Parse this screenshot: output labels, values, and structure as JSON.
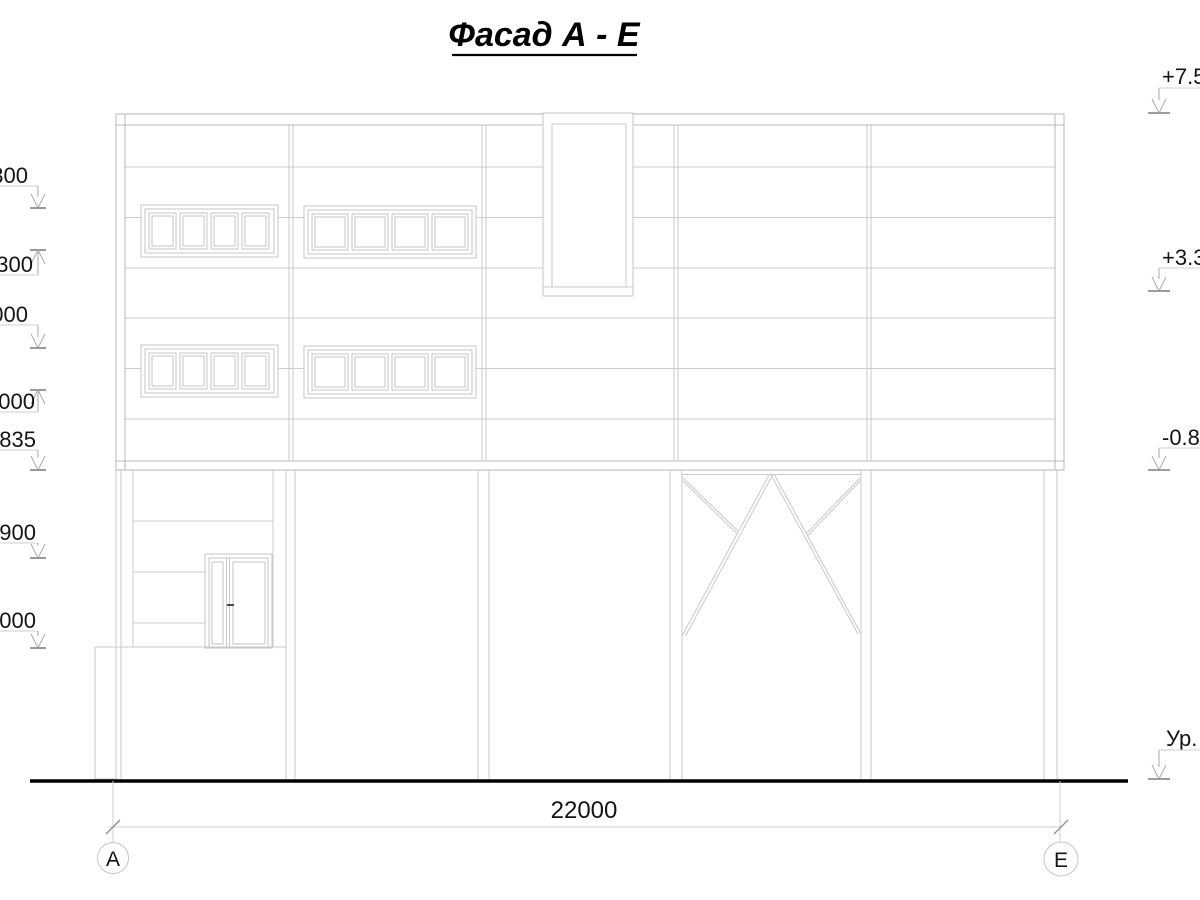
{
  "title": "Фасад А - Е",
  "dimension": {
    "label": "22000"
  },
  "axes": {
    "left": "А",
    "right": "Е"
  },
  "levels_left": [
    {
      "label": "300"
    },
    {
      "label": ".300"
    },
    {
      "label": "000"
    },
    {
      "label": ".000"
    },
    {
      "label": ".835"
    },
    {
      "label": ".900"
    },
    {
      "label": ".000"
    }
  ],
  "levels_right": [
    {
      "label": "+7.50"
    },
    {
      "label": "+3.30"
    },
    {
      "label": "-0.83"
    },
    {
      "label": "Ур."
    }
  ],
  "colors": {
    "line_light": "#c9c9c9",
    "line_mid": "#b9b9b9",
    "arrow": "#aaaaaa",
    "tick": "#8f8f8f",
    "ink": "#141414",
    "ground": "#000000"
  }
}
